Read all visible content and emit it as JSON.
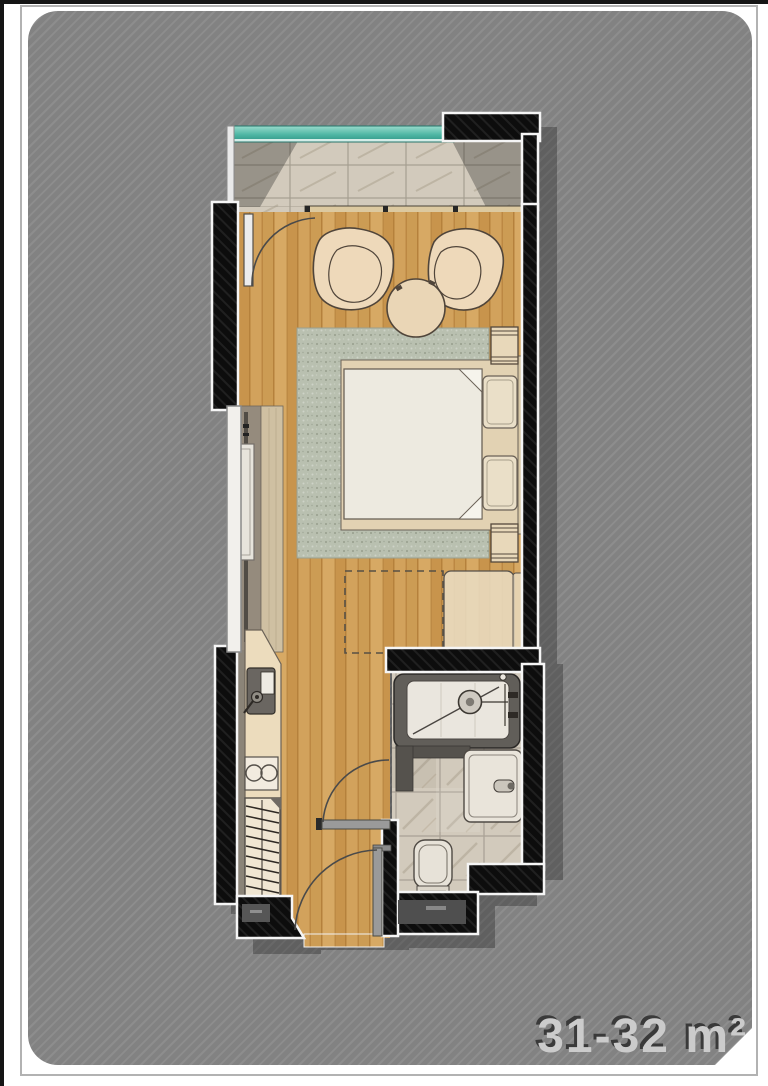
{
  "page": {
    "title": "apartment-floor-plan",
    "area_label": "31-32 m²"
  },
  "palette": {
    "sheet_gray": "#828282",
    "sheet_stripe": "#8d8d8d",
    "wall_black": "#0d0d0d",
    "wall_outline_white": "#f5f5f5",
    "wood_floor": "#cfa058",
    "balcony_glass_teal": "#4db6a4",
    "balcony_tile": "#d2cabc",
    "bathroom_tile": "#d2cabc",
    "rug_green_gray": "#b9c0b0",
    "bed_linen_white": "#edeae0",
    "furniture_beige": "#eed9ba",
    "counter_tan": "#ecdcbd",
    "shadow_gray": "#626262",
    "label_gray": "#cbcbcb",
    "label_shadow": "#3a3a3a"
  },
  "plan": {
    "rooms": [
      {
        "name": "balcony"
      },
      {
        "name": "living-bedroom"
      },
      {
        "name": "kitchenette"
      },
      {
        "name": "bathroom"
      },
      {
        "name": "entry"
      }
    ],
    "furniture": [
      "armchair-left",
      "armchair-right",
      "coffee-table",
      "area-rug",
      "double-bed",
      "pillows",
      "headboard",
      "nightstand-top",
      "nightstand-bottom",
      "bench",
      "sofa-bed-dashed-outline",
      "wardrobe-sliding",
      "kitchen-counter",
      "kitchen-sink",
      "two-burner-cooktop",
      "shelf-unit",
      "shower",
      "vanity-sink",
      "toilet",
      "balcony-door",
      "bathroom-door",
      "entry-door",
      "sliding-window"
    ]
  }
}
